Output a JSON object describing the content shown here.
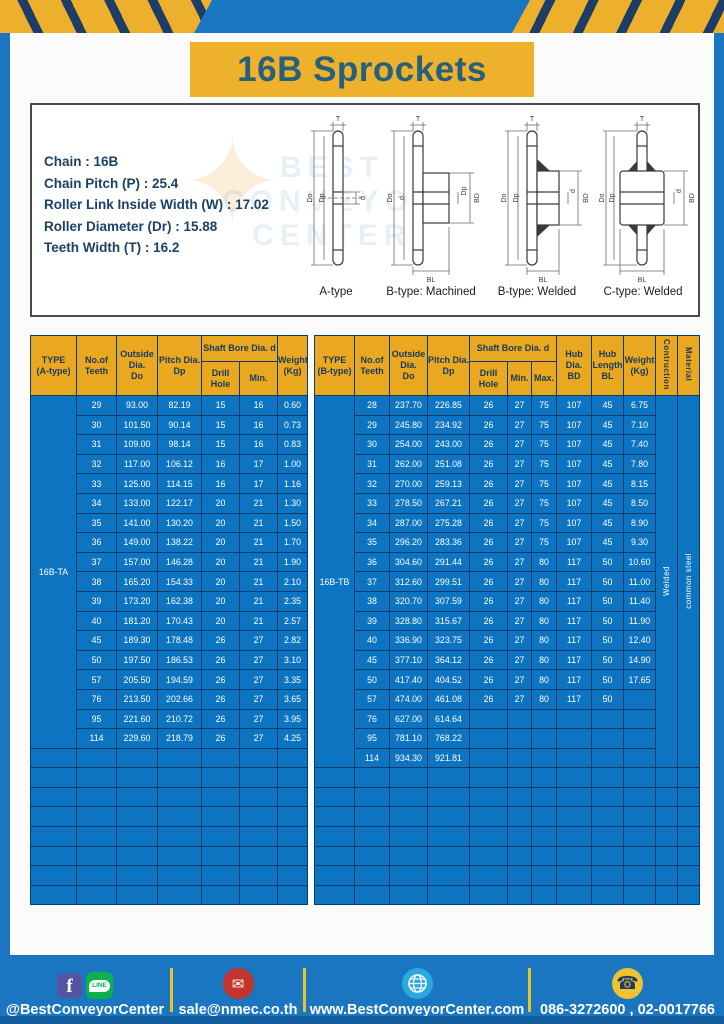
{
  "page": {
    "title": "16B Sprockets"
  },
  "specs": {
    "lines": [
      "Chain  :  16B",
      "Chain Pitch (P)  :  25.4",
      "Roller Link Inside Width (W)  :  17.02",
      "Roller Diameter (Dr)  : 15.88",
      "Teeth Width (T)  :  16.2"
    ]
  },
  "watermark": {
    "star": "✦",
    "l1": "BEST",
    "l2": "CONVEYOR",
    "l3": "CENTER"
  },
  "drawings": {
    "labels": [
      "A-type",
      "B-type: Machined",
      "B-type: Welded",
      "C-type: Welded"
    ],
    "dims": {
      "t": "T",
      "do": "Do",
      "dp": "Dp",
      "d": "d",
      "bd": "BD",
      "bl": "BL"
    }
  },
  "tables": {
    "a": {
      "type_label": "16B-TA",
      "header": {
        "type_l1": "TYPE",
        "type_l2": "(A-type)",
        "teeth_l1": "No.of",
        "teeth_l2": "Teeth",
        "od_l1": "Outside",
        "od_l2": "Dia.",
        "od_l3": "Do",
        "pd_l1": "Pitch Dia.",
        "pd_l2": "Dp",
        "bore": "Shaft Bore Dia. d",
        "drill": "Drill Hole",
        "min": "Min.",
        "wt_l1": "Weight",
        "wt_l2": "(Kg)"
      },
      "rows": [
        [
          "29",
          "93.00",
          "82.19",
          "15",
          "16",
          "0.60"
        ],
        [
          "30",
          "101.50",
          "90.14",
          "15",
          "16",
          "0.73"
        ],
        [
          "31",
          "109.00",
          "98.14",
          "15",
          "16",
          "0.83"
        ],
        [
          "32",
          "117.00",
          "106.12",
          "16",
          "17",
          "1.00"
        ],
        [
          "33",
          "125.00",
          "114.15",
          "16",
          "17",
          "1.16"
        ],
        [
          "34",
          "133.00",
          "122.17",
          "20",
          "21",
          "1.30"
        ],
        [
          "35",
          "141.00",
          "130.20",
          "20",
          "21",
          "1.50"
        ],
        [
          "36",
          "149.00",
          "138.22",
          "20",
          "21",
          "1.70"
        ],
        [
          "37",
          "157.00",
          "146.28",
          "20",
          "21",
          "1.90"
        ],
        [
          "38",
          "165.20",
          "154.33",
          "20",
          "21",
          "2.10"
        ],
        [
          "39",
          "173.20",
          "162.38",
          "20",
          "21",
          "2.35"
        ],
        [
          "40",
          "181.20",
          "170.43",
          "20",
          "21",
          "2.57"
        ],
        [
          "45",
          "189.30",
          "178.48",
          "26",
          "27",
          "2.82"
        ],
        [
          "50",
          "197.50",
          "186.53",
          "26",
          "27",
          "3.10"
        ],
        [
          "57",
          "205.50",
          "194.59",
          "26",
          "27",
          "3.35"
        ],
        [
          "76",
          "213.50",
          "202.66",
          "26",
          "27",
          "3.65"
        ],
        [
          "95",
          "221.60",
          "210.72",
          "26",
          "27",
          "3.95"
        ],
        [
          "114",
          "229.60",
          "218.79",
          "26",
          "27",
          "4.25"
        ]
      ],
      "empty_rows": 8
    },
    "b": {
      "type_label": "16B-TB",
      "header": {
        "type_l1": "TYPE",
        "type_l2": "(B-type)",
        "teeth_l1": "No.of",
        "teeth_l2": "Teeth",
        "od_l1": "Outside",
        "od_l2": "Dia.",
        "od_l3": "Do",
        "pd_l1": "Pitch Dia.",
        "pd_l2": "Dp",
        "bore": "Shaft Bore Dia. d",
        "drill": "Drill Hole",
        "min": "Min.",
        "max": "Max.",
        "hubdia_l1": "Hub Dia.",
        "hubdia_l2": "BD",
        "hublen_l1": "Hub",
        "hublen_l2": "Length",
        "hublen_l3": "BL",
        "wt_l1": "Weight",
        "wt_l2": "(Kg)",
        "construction": "Contruction",
        "material": "Material"
      },
      "rows": [
        [
          "28",
          "237.70",
          "226.85",
          "26",
          "27",
          "75",
          "107",
          "45",
          "6.75"
        ],
        [
          "29",
          "245.80",
          "234.92",
          "26",
          "27",
          "75",
          "107",
          "45",
          "7.10"
        ],
        [
          "30",
          "254.00",
          "243.00",
          "26",
          "27",
          "75",
          "107",
          "45",
          "7.40"
        ],
        [
          "31",
          "262.00",
          "251.08",
          "26",
          "27",
          "75",
          "107",
          "45",
          "7.80"
        ],
        [
          "32",
          "270.00",
          "259.13",
          "26",
          "27",
          "75",
          "107",
          "45",
          "8.15"
        ],
        [
          "33",
          "278.50",
          "267.21",
          "26",
          "27",
          "75",
          "107",
          "45",
          "8.50"
        ],
        [
          "34",
          "287.00",
          "275.28",
          "26",
          "27",
          "75",
          "107",
          "45",
          "8.90"
        ],
        [
          "35",
          "296.20",
          "283.36",
          "26",
          "27",
          "75",
          "107",
          "45",
          "9.30"
        ],
        [
          "36",
          "304.60",
          "291.44",
          "26",
          "27",
          "80",
          "117",
          "50",
          "10.60"
        ],
        [
          "37",
          "312.60",
          "299.51",
          "26",
          "27",
          "80",
          "117",
          "50",
          "11.00"
        ],
        [
          "38",
          "320.70",
          "307.59",
          "26",
          "27",
          "80",
          "117",
          "50",
          "11.40"
        ],
        [
          "39",
          "328.80",
          "315.67",
          "26",
          "27",
          "80",
          "117",
          "50",
          "11.90"
        ],
        [
          "40",
          "336.90",
          "323.75",
          "26",
          "27",
          "80",
          "117",
          "50",
          "12.40"
        ],
        [
          "45",
          "377.10",
          "364.12",
          "26",
          "27",
          "80",
          "117",
          "50",
          "14.90"
        ],
        [
          "50",
          "417.40",
          "404.52",
          "26",
          "27",
          "80",
          "117",
          "50",
          "17.65"
        ],
        [
          "57",
          "474.00",
          "461.08",
          "26",
          "27",
          "80",
          "117",
          "50",
          ""
        ],
        [
          "76",
          "627.00",
          "614.64",
          "",
          "",
          "",
          "",
          "",
          ""
        ],
        [
          "95",
          "781.10",
          "768.22",
          "",
          "",
          "",
          "",
          "",
          ""
        ],
        [
          "114",
          "934.30",
          "921.81",
          "",
          "",
          "",
          "",
          "",
          ""
        ]
      ],
      "construction_value": "Welded",
      "material_value": "common steel",
      "empty_rows": 7
    }
  },
  "footer": {
    "social": "@BestConveyorCenter",
    "email": "sale@nmec.co.th",
    "website": "www.BestConveyorCenter.com",
    "phones": "086-3272600 , 02-0017766",
    "icons": {
      "facebook_glyph": "f",
      "line_text": "LINE",
      "mail_glyph": "✉",
      "phone_glyph": "☎"
    }
  },
  "colors": {
    "background_blue": "#1a76c0",
    "hazard_yellow": "#edb02c",
    "navy": "#1d3c66",
    "banner_yellow": "#eeb12c",
    "title_text": "#27607c",
    "table_header_yellow": "#e9a81f",
    "table_cell_blue": "#0d74c2",
    "table_border_navy": "#0c3c6b"
  }
}
